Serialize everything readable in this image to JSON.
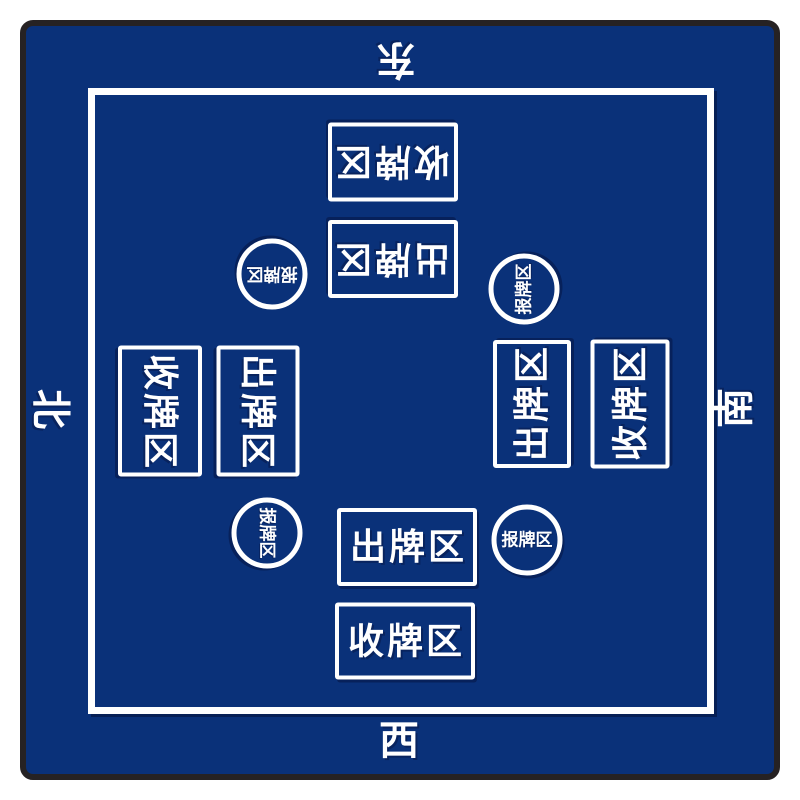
{
  "mat": {
    "surface_color": "#0a3179",
    "edge_color": "#262223",
    "line_color": "#ffffff"
  },
  "compass": {
    "east": "东",
    "south": "南",
    "west": "西",
    "north": "北"
  },
  "zone_labels": {
    "play": "出牌区",
    "collect": "收牌区",
    "report": "报牌区"
  },
  "seats": [
    {
      "position": "top",
      "compass": "东",
      "zones_from_edge": [
        "收牌区",
        "出牌区"
      ],
      "report_zone": "报牌区",
      "text_rotation_deg": 180
    },
    {
      "position": "right",
      "compass": "南",
      "zones_from_edge": [
        "收牌区",
        "出牌区"
      ],
      "report_zone": "报牌区",
      "text_rotation_deg": -90
    },
    {
      "position": "bottom",
      "compass": "西",
      "zones_from_edge": [
        "收牌区",
        "出牌区"
      ],
      "report_zone": "报牌区",
      "text_rotation_deg": 0
    },
    {
      "position": "left",
      "compass": "北",
      "zones_from_edge": [
        "收牌区",
        "出牌区"
      ],
      "report_zone": "报牌区",
      "text_rotation_deg": 90
    }
  ]
}
